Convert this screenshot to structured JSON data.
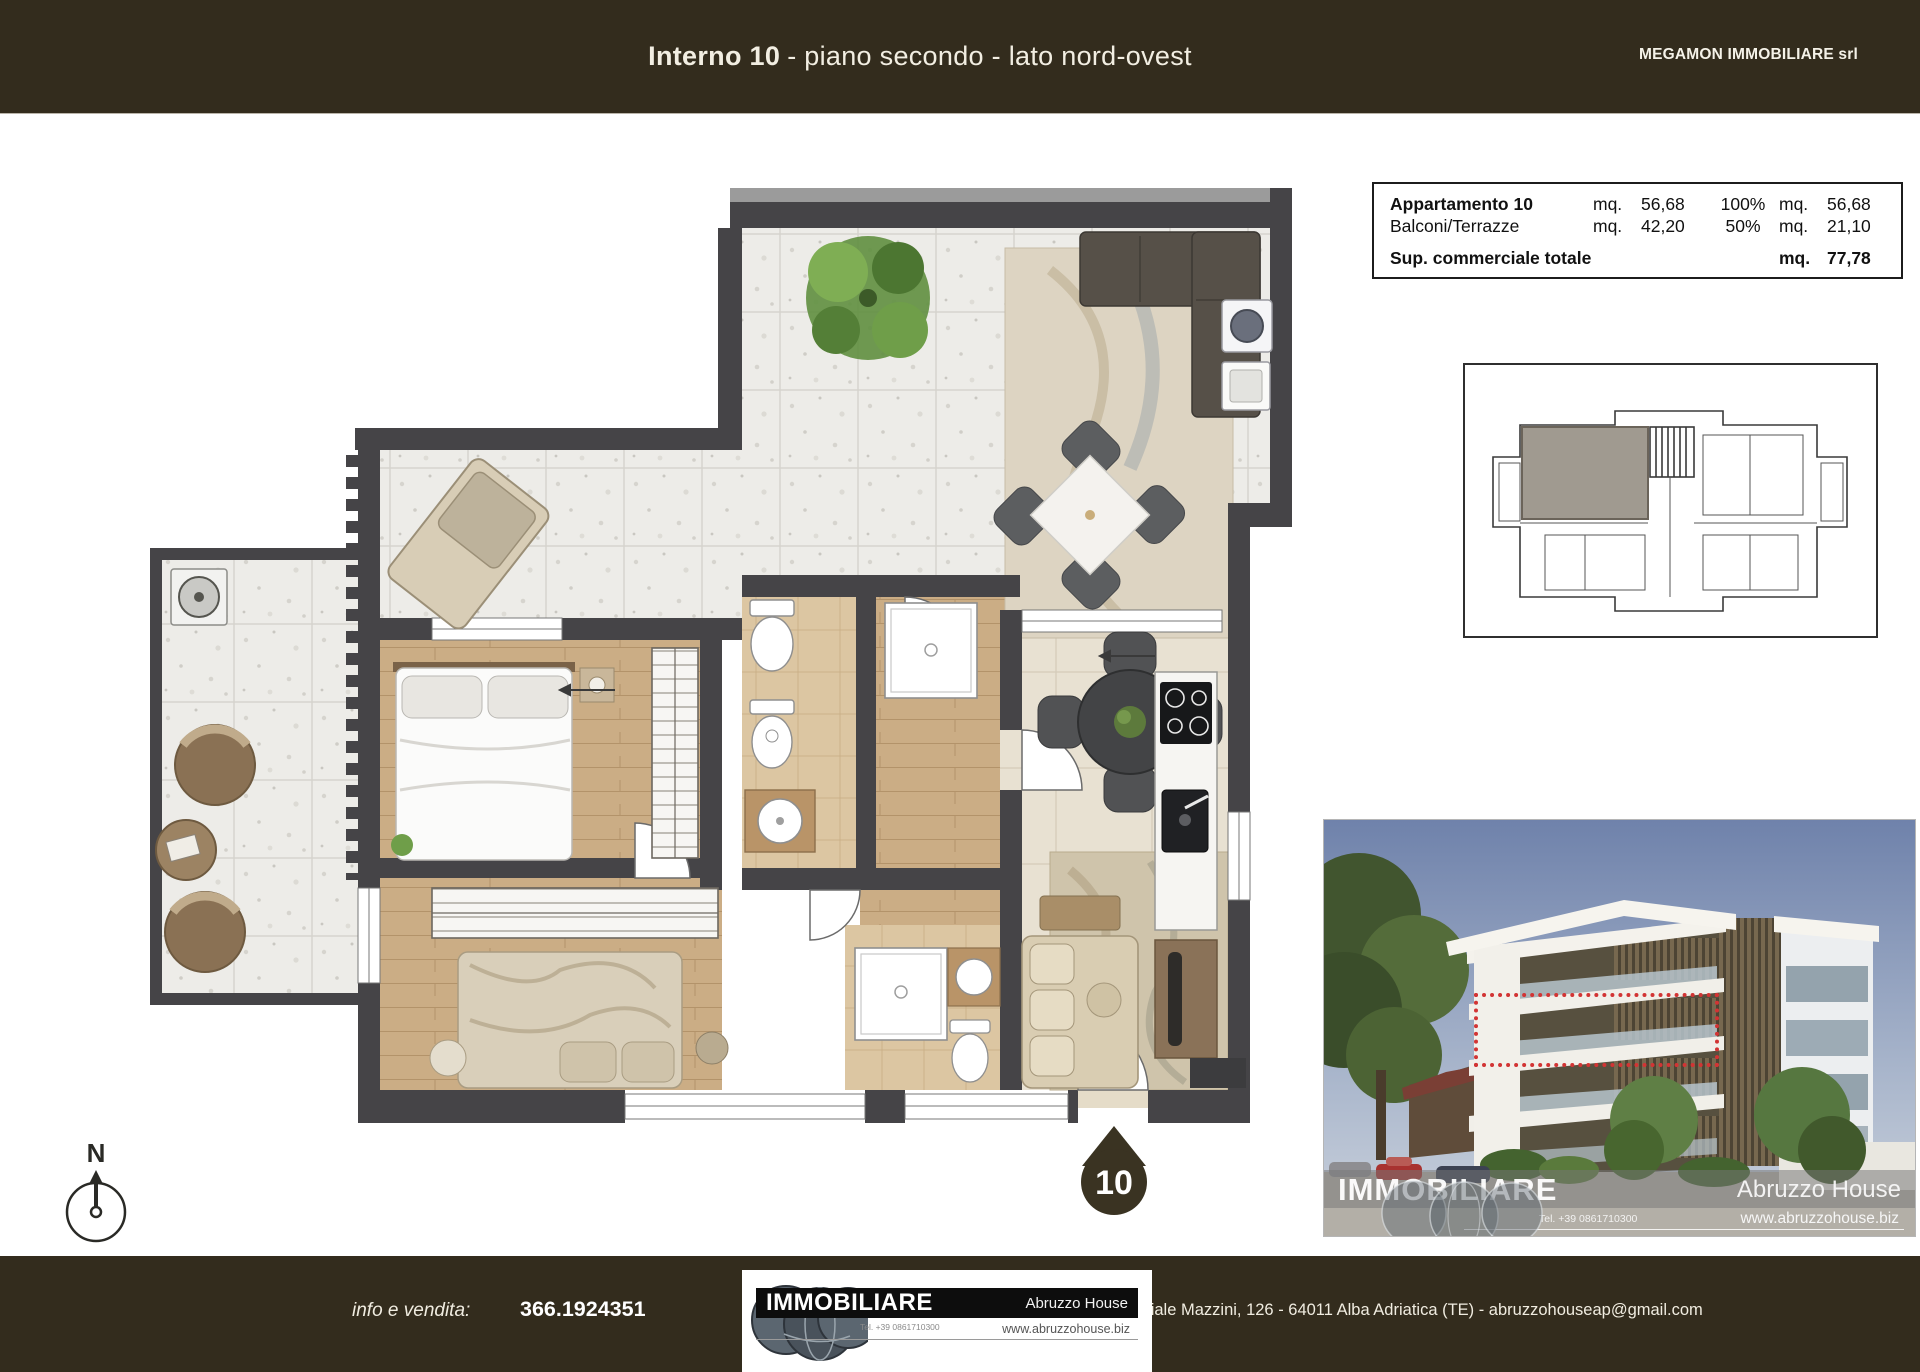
{
  "header": {
    "title_bold": "Interno 10",
    "title_rest": "- piano secondo - lato nord-ovest",
    "company": "MEGAMON IMMOBILIARE srl"
  },
  "area_table": {
    "rows": [
      {
        "label": "Appartamento 10",
        "unit1": "mq.",
        "value1": "56,68",
        "percent": "100%",
        "unit2": "mq.",
        "value2": "56,68"
      },
      {
        "label": "Balconi/Terrazze",
        "unit1": "mq.",
        "value1": "42,20",
        "percent": "50%",
        "unit2": "mq.",
        "value2": "21,10"
      }
    ],
    "total": {
      "label": "Sup. commerciale totale",
      "unit": "mq.",
      "value": "77,78"
    }
  },
  "plan": {
    "unit_marker": "10",
    "north_label": "N"
  },
  "photo": {
    "watermark_brand": "IMMOBILIARE",
    "watermark_name": "Abruzzo House",
    "watermark_tel": "Tel. +39 0861710300",
    "watermark_site": "www.abruzzohouse.biz",
    "highlight_color": "#d23434"
  },
  "footer": {
    "info_label": "info e vendita:",
    "phone": "366.1924351",
    "logo_brand": "IMMOBILIARE",
    "logo_name": "Abruzzo House",
    "logo_tel": "Tel. +39 0861710300",
    "logo_site": "www.abruzzohouse.biz",
    "address": "Viale Mazzini, 126 - 64011 Alba Adriatica (TE) - abruzzohouseap@gmail.com"
  },
  "colors": {
    "header_bg": "#332c1d",
    "wall": "#454447",
    "marker_bg": "#3a3322",
    "highlight_red": "#d23434"
  }
}
